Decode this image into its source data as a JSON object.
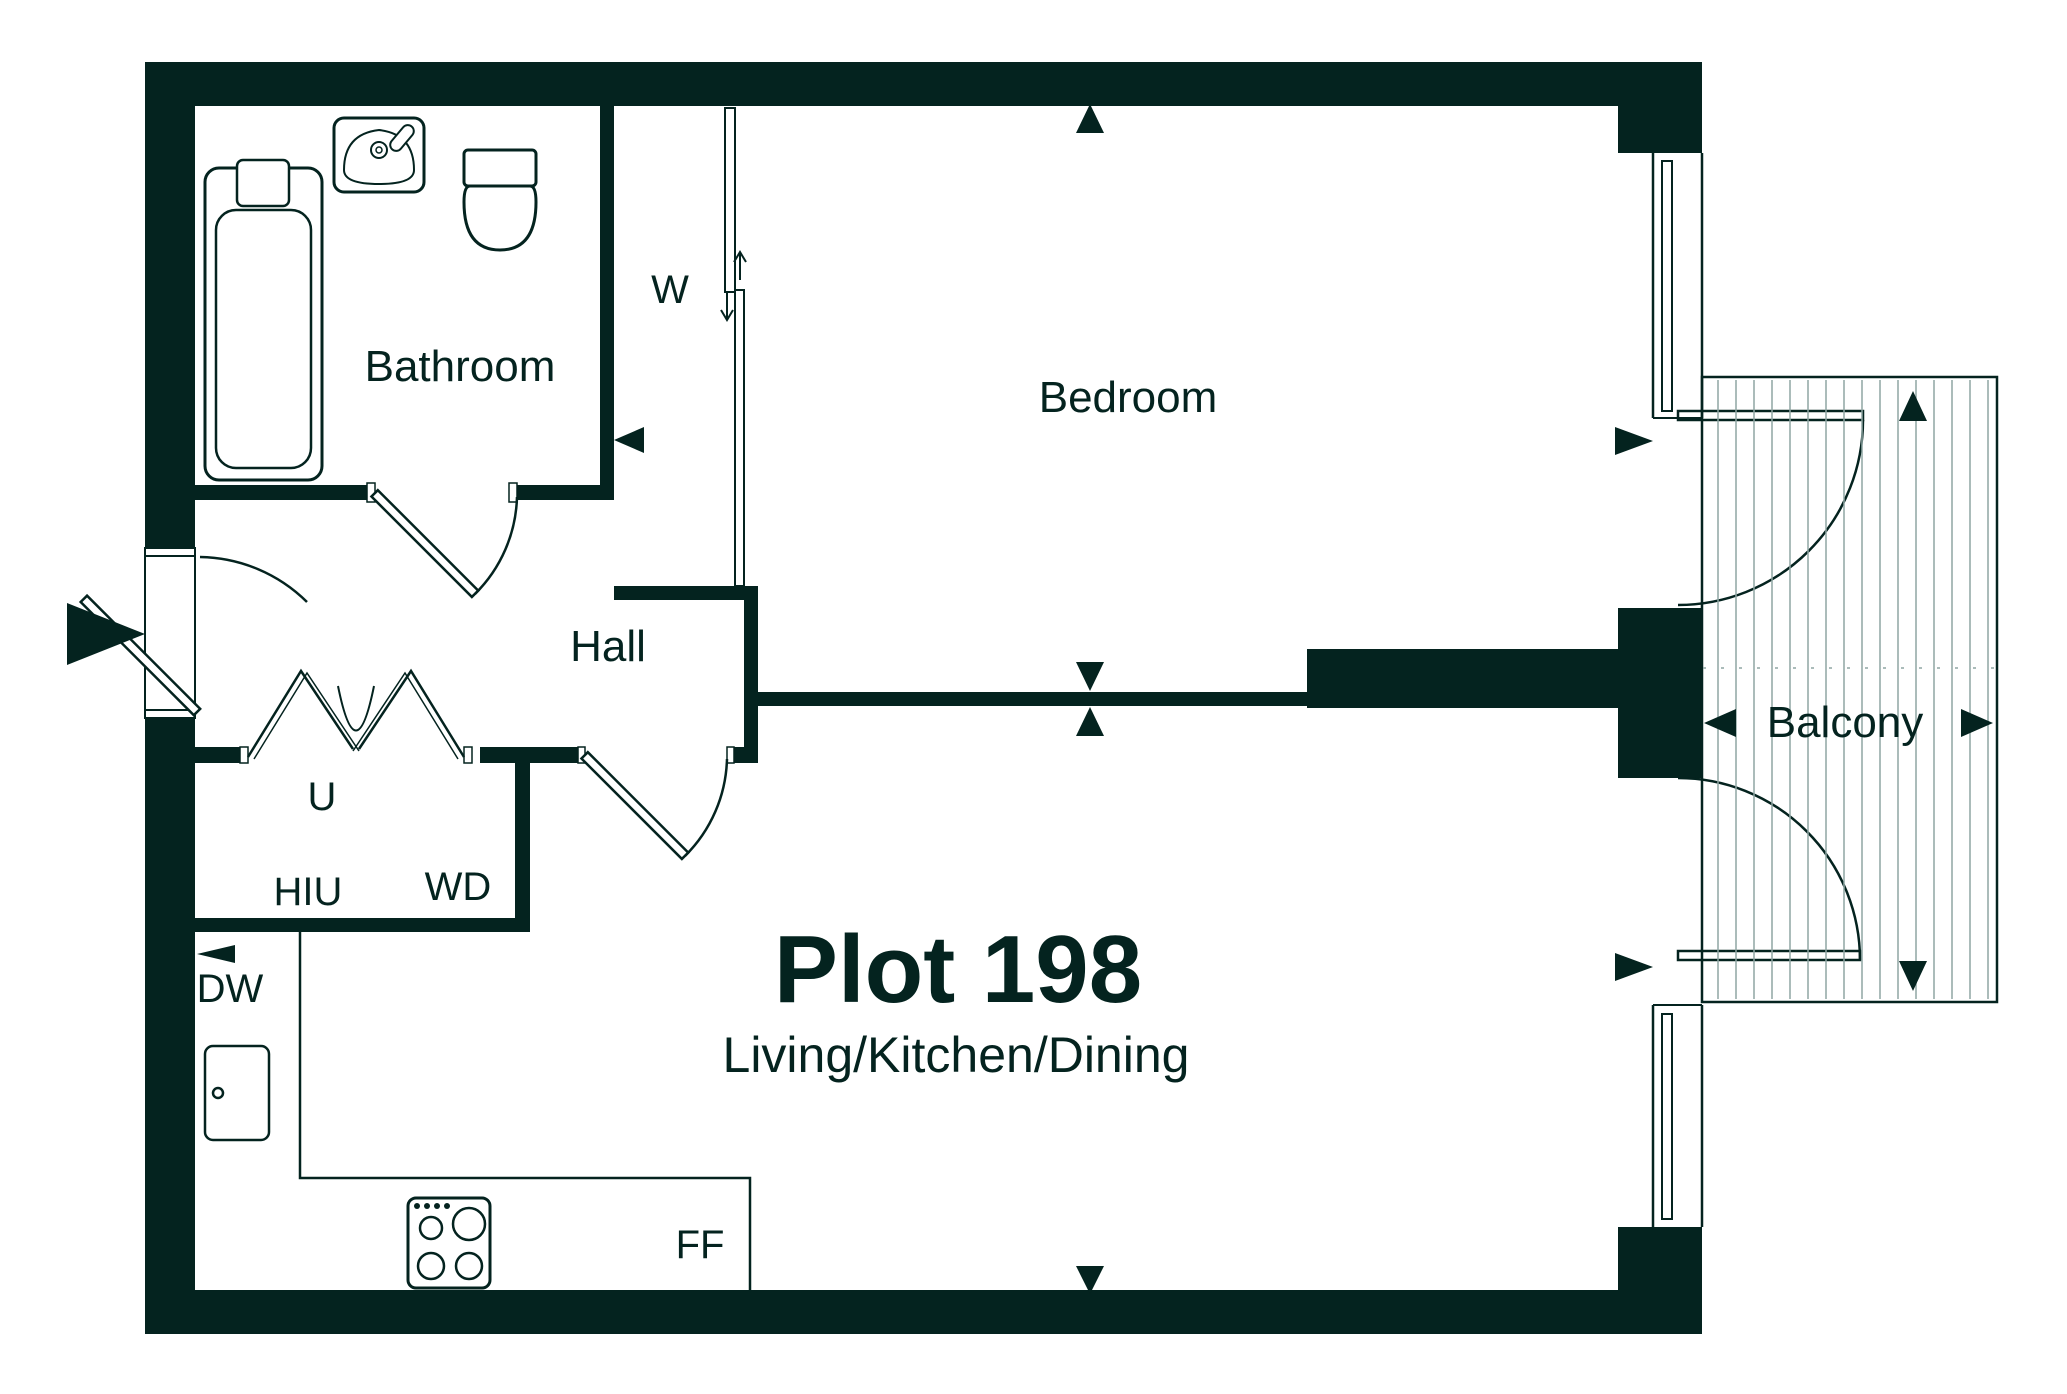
{
  "plan": {
    "title": "Plot 198",
    "subtitle": "Living/Kitchen/Dining",
    "rooms": {
      "bathroom": "Bathroom",
      "bedroom": "Bedroom",
      "hall": "Hall",
      "balcony": "Balcony"
    },
    "features": {
      "wardrobe": "W",
      "utility": "U",
      "hiu": "HIU",
      "washer_dryer": "WD",
      "dishwasher": "DW",
      "fridge_freezer": "FF"
    },
    "colors": {
      "wall": "#04231f",
      "decking": "#8fa6a3",
      "background": "#ffffff"
    }
  }
}
